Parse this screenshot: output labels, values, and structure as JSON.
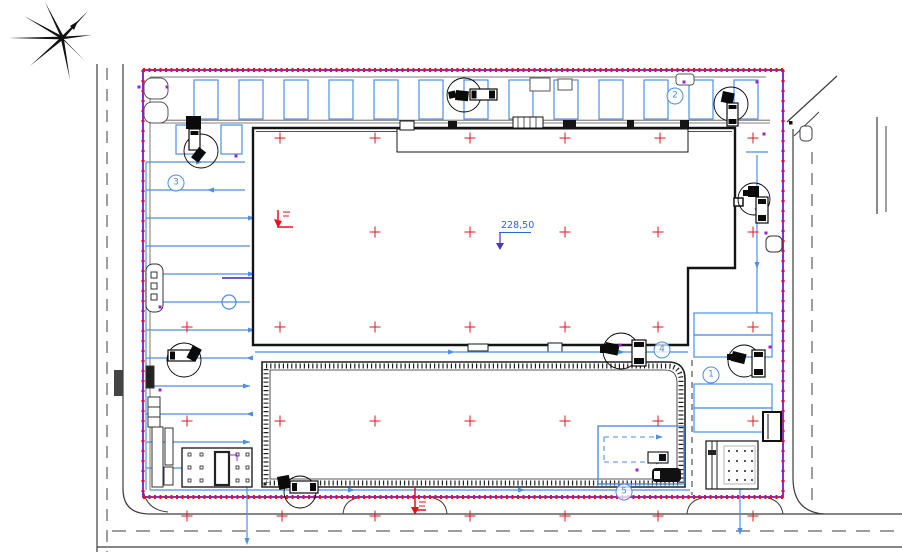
{
  "plan": {
    "elevation": {
      "label": "228,50",
      "x": 501,
      "y": 220
    },
    "callouts": [
      {
        "label": "1",
        "x": 711,
        "y": 375
      },
      {
        "label": "2",
        "x": 675,
        "y": 96
      },
      {
        "label": "3",
        "x": 176,
        "y": 183
      },
      {
        "label": "4",
        "x": 662,
        "y": 350
      },
      {
        "label": "5",
        "x": 624,
        "y": 492
      }
    ],
    "grid_crosses": [
      [
        280,
        138
      ],
      [
        375,
        138
      ],
      [
        470,
        138
      ],
      [
        565,
        138
      ],
      [
        660,
        138
      ],
      [
        753,
        138
      ],
      [
        375,
        232
      ],
      [
        470,
        232
      ],
      [
        565,
        232
      ],
      [
        658,
        232
      ],
      [
        753,
        232
      ],
      [
        187,
        327
      ],
      [
        280,
        327
      ],
      [
        375,
        327
      ],
      [
        470,
        327
      ],
      [
        565,
        327
      ],
      [
        658,
        327
      ],
      [
        753,
        327
      ],
      [
        187,
        421
      ],
      [
        280,
        421
      ],
      [
        375,
        421
      ],
      [
        470,
        421
      ],
      [
        565,
        421
      ],
      [
        658,
        421
      ],
      [
        753,
        421
      ],
      [
        187,
        516
      ],
      [
        282,
        516
      ],
      [
        375,
        516
      ],
      [
        470,
        516
      ],
      [
        565,
        516
      ],
      [
        658,
        516
      ],
      [
        753,
        516
      ]
    ],
    "colors": {
      "boundary_purple": "#7d16c9",
      "hatch_red": "#e8101c",
      "parking_blue": "#4a8fe8",
      "building_outline": "#141414",
      "road_gray": "#3c3c3c",
      "cross_red": "#e8101c",
      "elevation_blue": "#2f63d8",
      "arrow_violet": "#5230cc",
      "point_purple": "#a020d0"
    }
  }
}
